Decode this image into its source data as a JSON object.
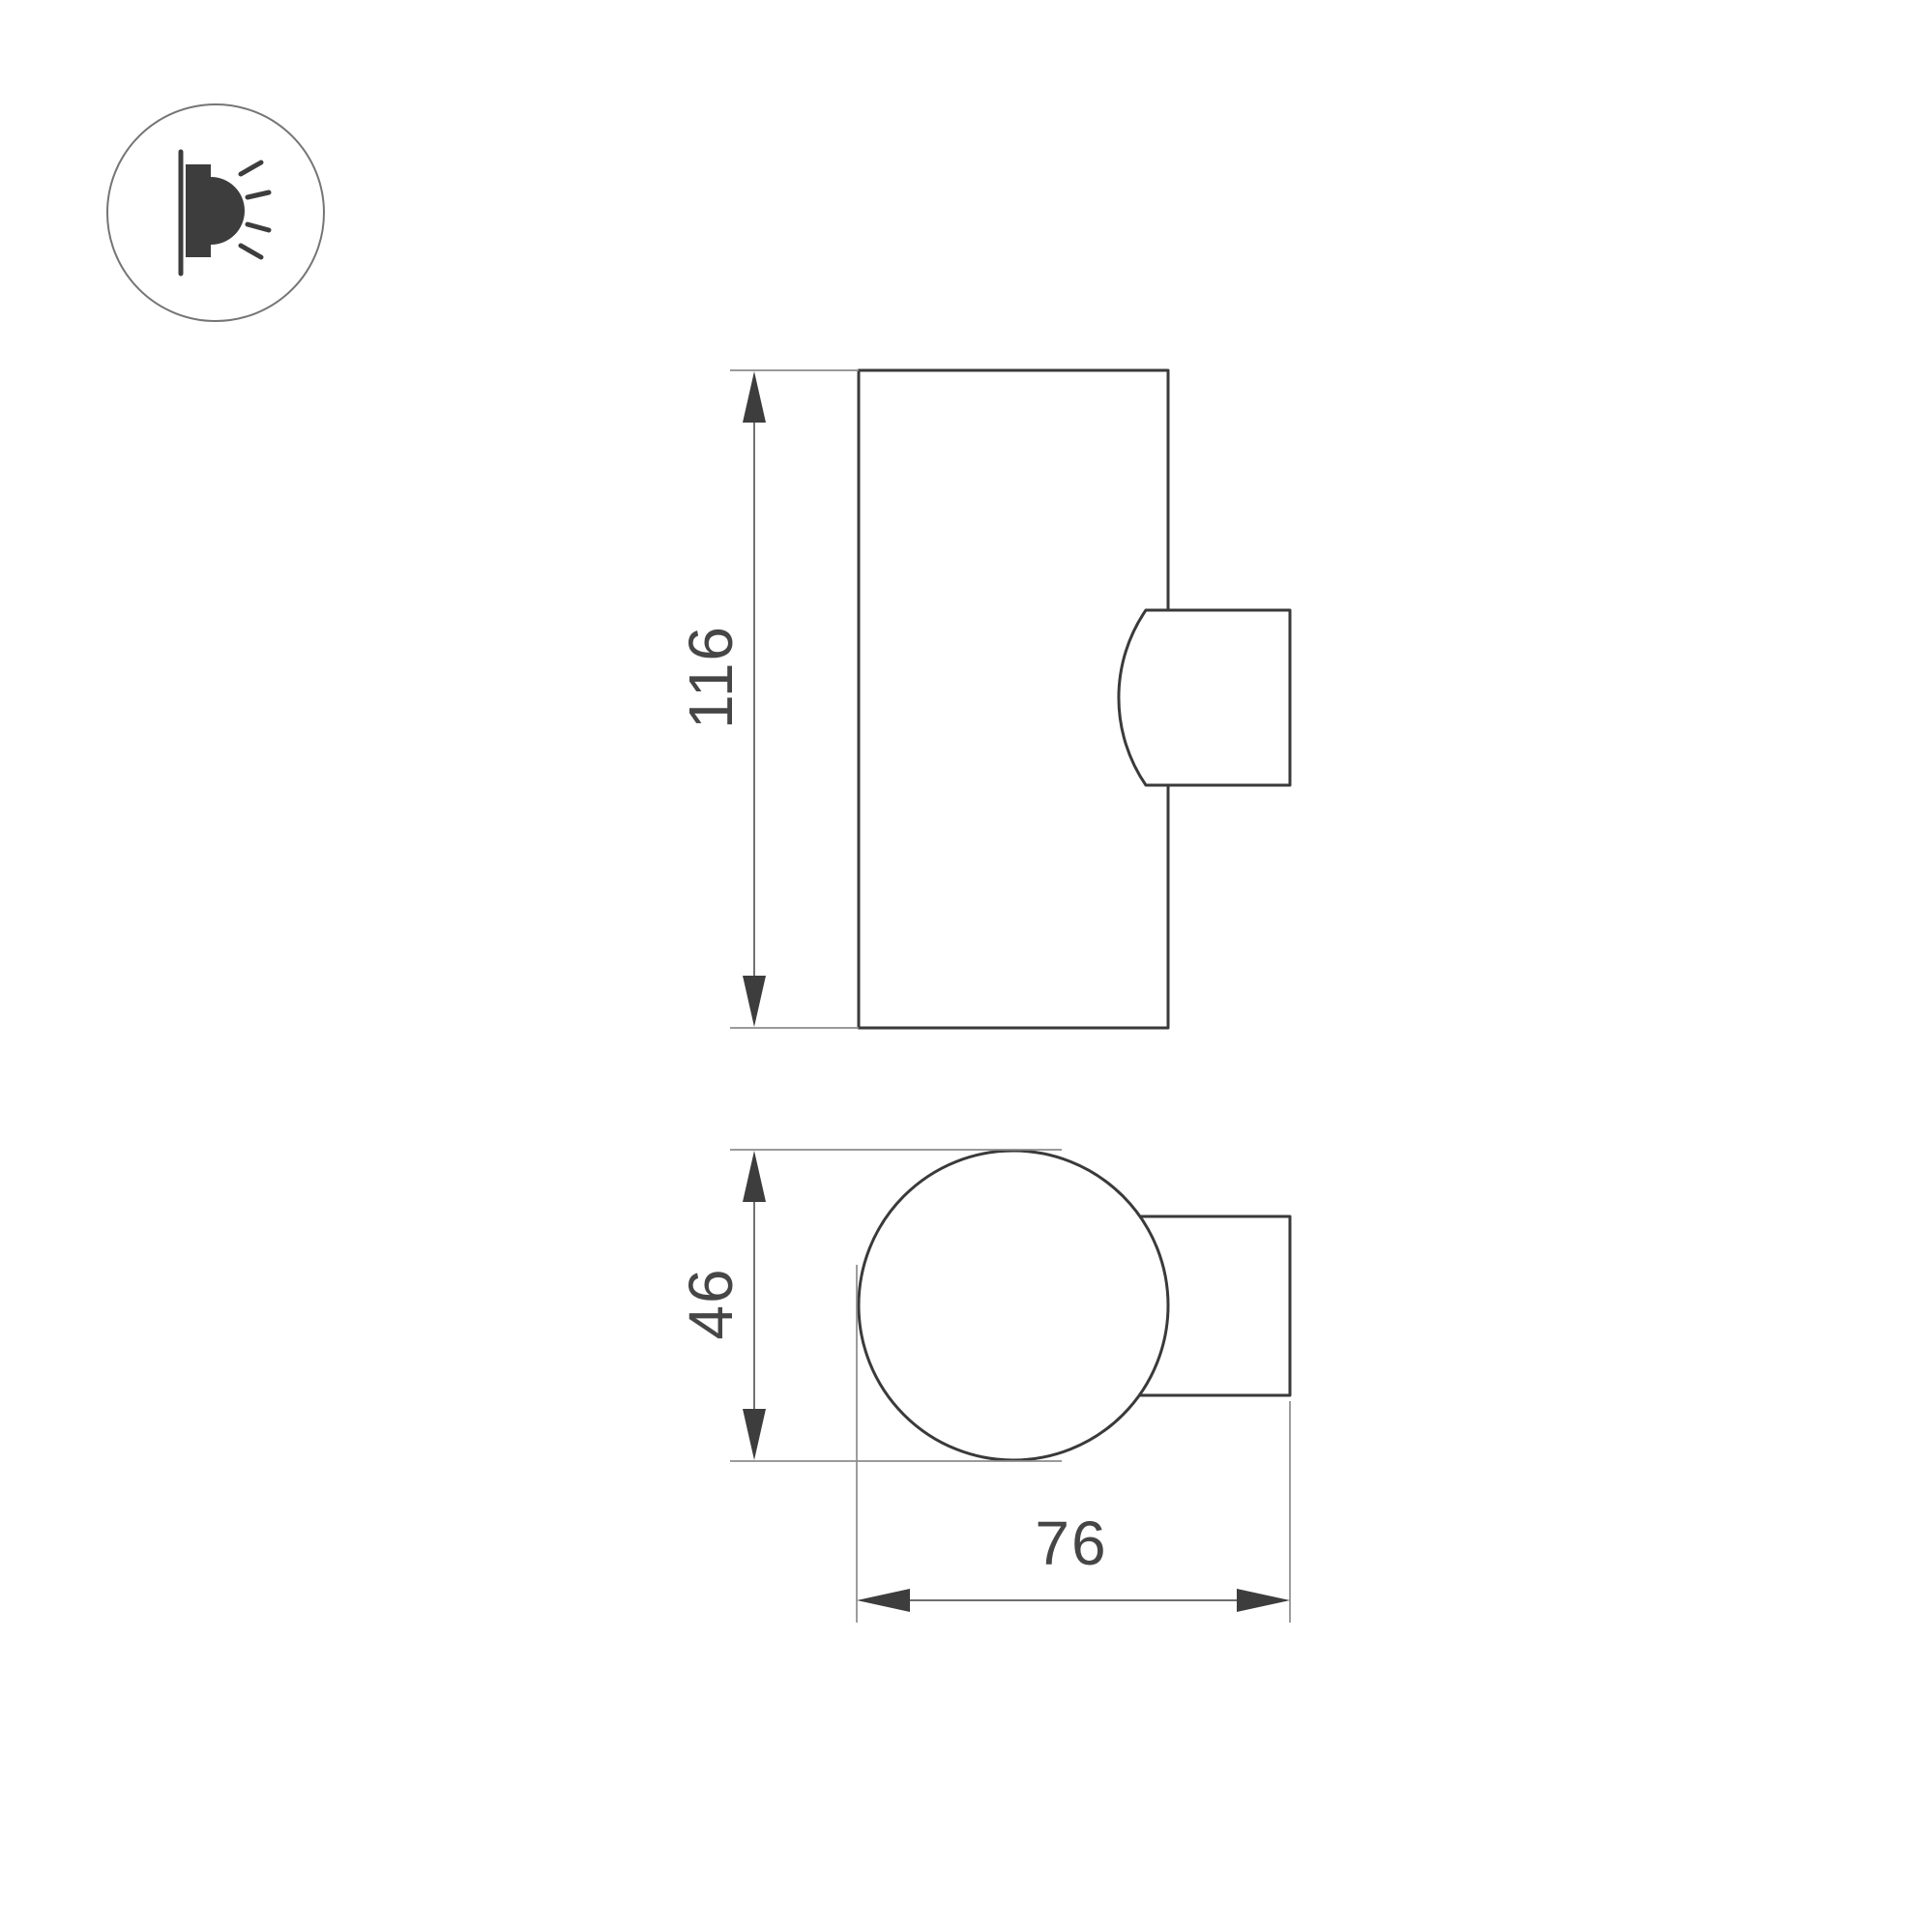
{
  "drawing": {
    "type": "technical-dimension-drawing",
    "views": {
      "front_view": "cylindrical wall luminaire body with wall-mount bracket on right side",
      "top_view": "circular body section with wall-mount bracket on right side"
    },
    "dimensions": {
      "height_label": "116",
      "diameter_label": "46",
      "depth_label": "76"
    },
    "colors": {
      "background": "#ffffff",
      "outline": "#3a3a3a",
      "dimension_line": "#5a5a5a",
      "extension_line": "#8c8c8c",
      "text": "#464646",
      "icon": "#3d3d3d",
      "icon_ring": "#757575"
    }
  },
  "icon": {
    "name": "wall-light-emission-icon",
    "meaning": "wall-mounted luminaire emitting light sideways"
  }
}
